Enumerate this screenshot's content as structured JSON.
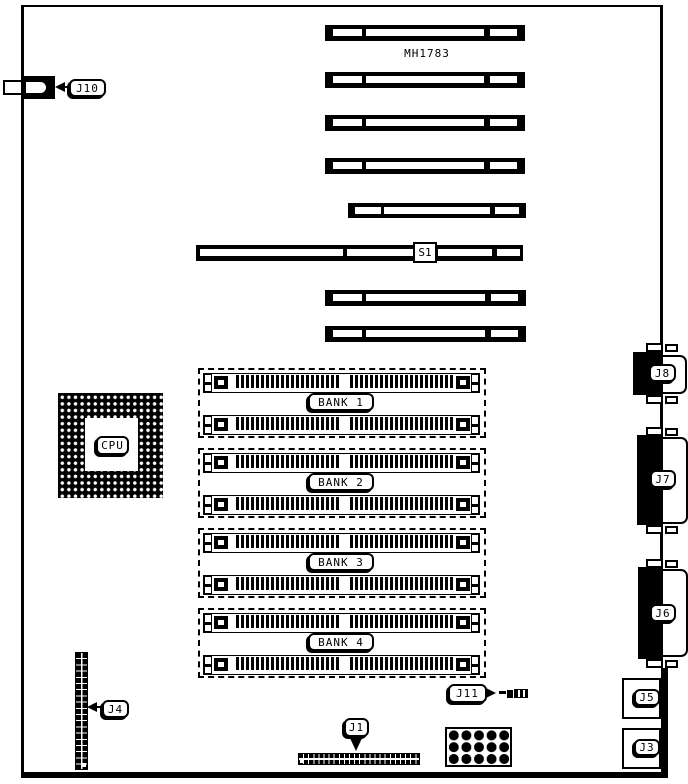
{
  "page": {
    "background": "#ffffff",
    "ink": "#000000"
  },
  "board": {
    "part_number": "MH1783",
    "switch_label": "S1",
    "cpu_label": "CPU",
    "memory_banks": [
      {
        "label": "BANK 1"
      },
      {
        "label": "BANK 2"
      },
      {
        "label": "BANK 3"
      },
      {
        "label": "BANK 4"
      }
    ],
    "connectors": {
      "j10": "J10",
      "j8": "J8",
      "j7": "J7",
      "j6": "J6",
      "j5": "J5",
      "j3": "J3",
      "j4": "J4",
      "j1": "J1",
      "j11": "J11"
    }
  }
}
